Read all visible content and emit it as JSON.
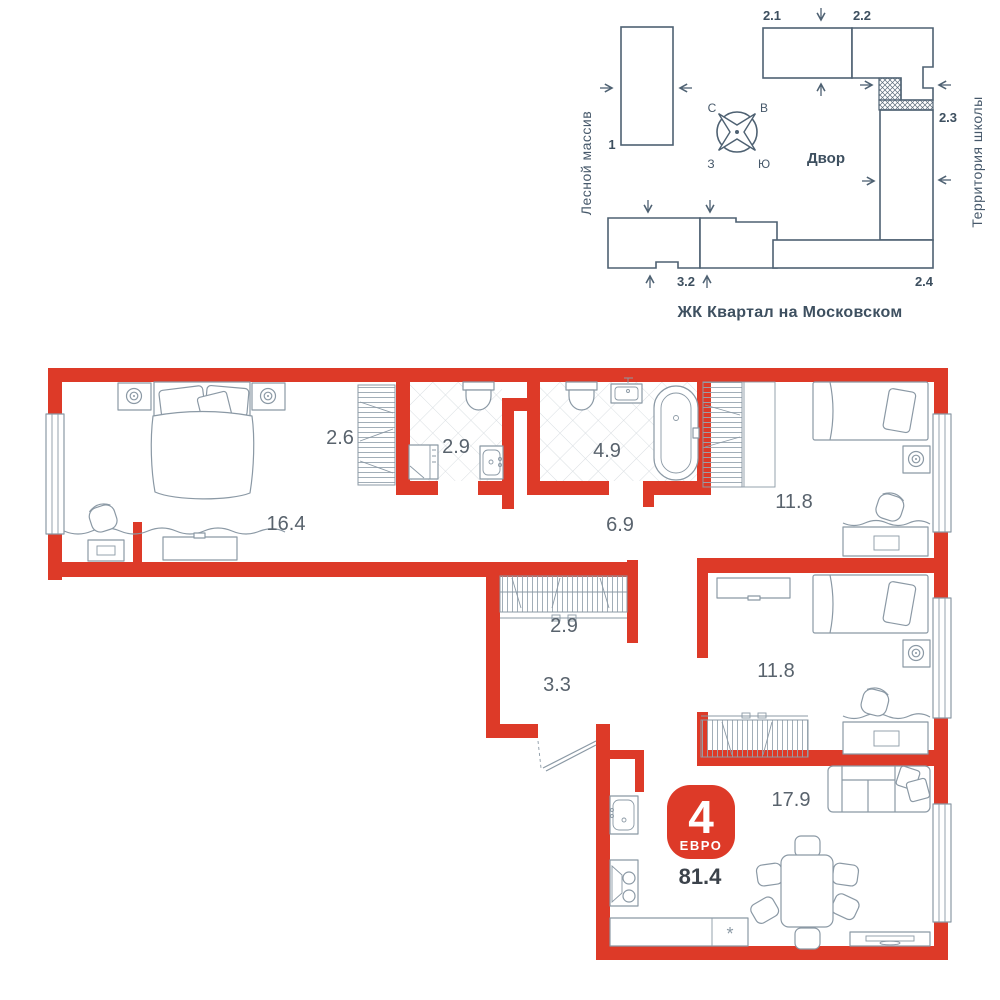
{
  "site_plan": {
    "caption": "ЖК Квартал на Московском",
    "area_left_label": "Лесной массив",
    "area_right_label": "Территория школы",
    "courtyard_label": "Двор",
    "compass": {
      "north": "С",
      "east": "В",
      "west": "З",
      "south": "Ю"
    },
    "building_labels": {
      "b1": "1",
      "b2_1": "2.1",
      "b2_2": "2.2",
      "b2_3": "2.3",
      "b2_4": "2.4",
      "b3_2": "3.2"
    }
  },
  "floor_plan": {
    "badge": {
      "rooms_count": "4",
      "layout_type": "ЕВРО",
      "total_area": "81.4"
    },
    "room_areas": {
      "bedroom_master": "16.4",
      "wardrobe_niche": "2.6",
      "bathroom_small": "2.9",
      "bathroom_large": "4.9",
      "corridor": "6.9",
      "bedroom_1": "11.8",
      "bedroom_2": "11.8",
      "hall_closet": "2.9",
      "hall": "3.3",
      "kitchen_living": "17.9"
    },
    "dishwasher_mark": "*",
    "colors": {
      "wall_red": "#dd3a28",
      "plan_lines": "#8b99a5",
      "site_lines": "#4e6172",
      "label_text": "#59636d"
    }
  }
}
